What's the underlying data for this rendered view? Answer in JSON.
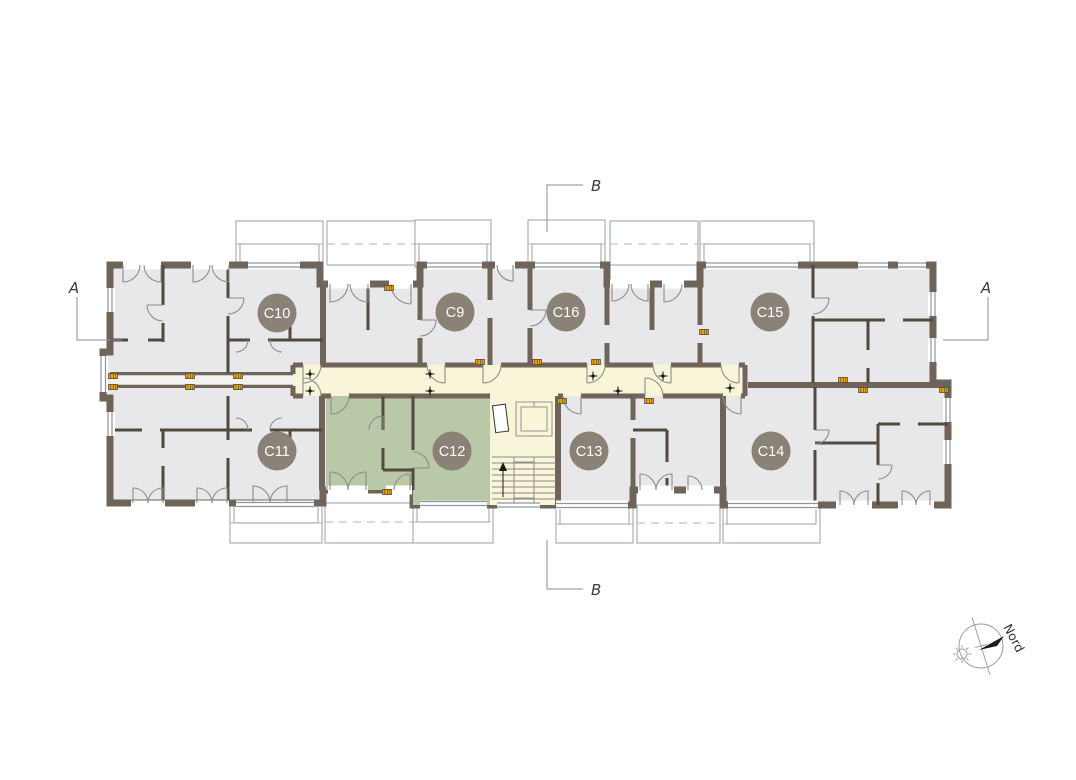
{
  "floor_plan": {
    "units": [
      {
        "id": "C10",
        "label": "C10",
        "status": "standard"
      },
      {
        "id": "C9",
        "label": "C9",
        "status": "standard"
      },
      {
        "id": "C16",
        "label": "C16",
        "status": "standard"
      },
      {
        "id": "C15",
        "label": "C15",
        "status": "standard"
      },
      {
        "id": "C11",
        "label": "C11",
        "status": "standard"
      },
      {
        "id": "C12",
        "label": "C12",
        "status": "highlighted"
      },
      {
        "id": "C13",
        "label": "C13",
        "status": "standard"
      },
      {
        "id": "C14",
        "label": "C14",
        "status": "standard"
      }
    ],
    "section_markers": {
      "a_left": "A",
      "a_right": "A",
      "b_top": "B",
      "b_bottom": "B"
    },
    "compass": {
      "label": "Nord"
    },
    "colors": {
      "wall": "#6e6459",
      "room_fill": "#e8e8ea",
      "corridor_fill": "#f9f5d8",
      "highlight_fill": "#b9c8a6",
      "unit_badge": "#8a8177",
      "marker_yellow": "#eaa500"
    }
  }
}
